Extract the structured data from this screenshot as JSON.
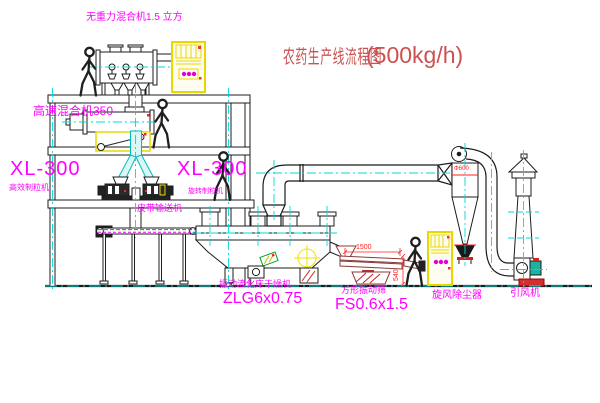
{
  "title": {
    "text": "农药生产线流程图",
    "capacity": "(500kg/h)"
  },
  "labels": {
    "gravity_mixer": "无重力混合机1.5 立方",
    "high_speed_mixer": "高速混合机350",
    "granulator_left_model": "XL-300",
    "granulator_left_name": "高效制粒机",
    "granulator_right_model": "XL-300",
    "granulator_right_name": "旋转制粒机",
    "belt_conveyor": "皮带输送机",
    "dryer_name": "振动流化床干燥机",
    "dryer_model": "ZLG6x0.75",
    "sieve_name": "方形振动筛",
    "sieve_model": "FS0.6x1.5",
    "cyclone": "旋风除尘器",
    "fan": "引风机"
  },
  "dimensions": {
    "sieve_length": "1500",
    "sieve_height": "540",
    "cyclone_inlet": "Φ600"
  },
  "colors": {
    "label_magenta": "#ff00ff",
    "title_red": "#cc5252",
    "dimension_red": "#ff2222",
    "centerline_cyan": "#00d8d8",
    "cabinet_yellow": "#f2e400",
    "line_dark": "#1c1c1c"
  }
}
